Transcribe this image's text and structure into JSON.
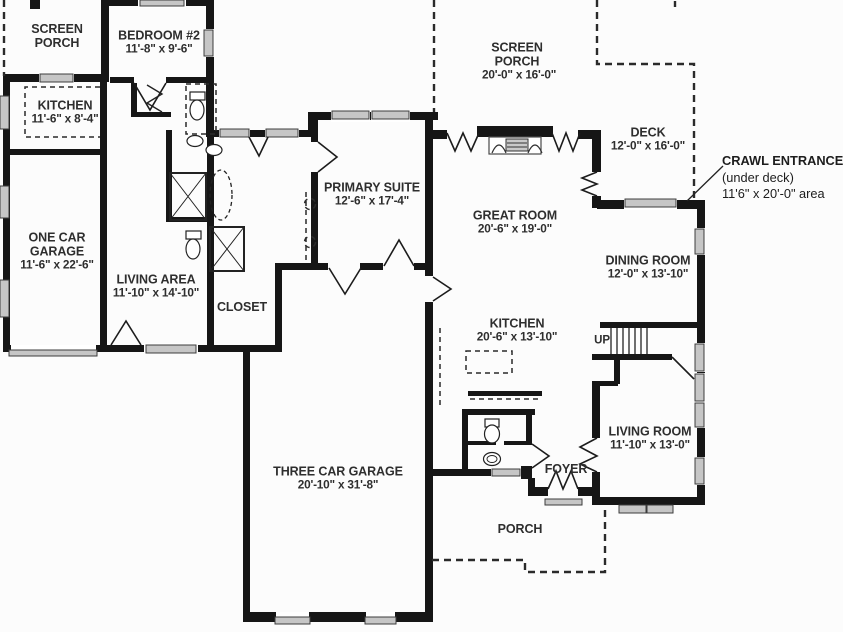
{
  "figure": {
    "type": "floor-plan",
    "wall_color": "#161616",
    "window_color": "#c6c6c6",
    "text_color": "#2e2e2e",
    "background": "#fcfcfc"
  },
  "rooms": [
    {
      "id": "screen-porch-left",
      "name": "SCREEN PORCH",
      "dims": ""
    },
    {
      "id": "bedroom-2",
      "name": "BEDROOM #2",
      "dims": "11'-8\" x 9'-6\""
    },
    {
      "id": "kitchen-left",
      "name": "KITCHEN",
      "dims": "11'-6\" x 8'-4\""
    },
    {
      "id": "one-car-garage",
      "name": "ONE CAR GARAGE",
      "dims": "11'-6\" x 22'-6\""
    },
    {
      "id": "living-area",
      "name": "LIVING AREA",
      "dims": "11'-10\" x 14'-10\""
    },
    {
      "id": "closet",
      "name": "CLOSET",
      "dims": ""
    },
    {
      "id": "primary-suite",
      "name": "PRIMARY SUITE",
      "dims": "12'-6\" x 17'-4\""
    },
    {
      "id": "screen-porch-main",
      "name": "SCREEN PORCH",
      "dims": "20'-0\" x 16'-0\""
    },
    {
      "id": "deck",
      "name": "DECK",
      "dims": "12'-0\" x 16'-0\""
    },
    {
      "id": "great-room",
      "name": "GREAT ROOM",
      "dims": "20'-6\" x 19'-0\""
    },
    {
      "id": "dining-room",
      "name": "DINING ROOM",
      "dims": "12'-0\" x 13'-10\""
    },
    {
      "id": "kitchen-main",
      "name": "KITCHEN",
      "dims": "20'-6\" x 13'-10\""
    },
    {
      "id": "living-room",
      "name": "LIVING ROOM",
      "dims": "11'-10\" x 13'-0\""
    },
    {
      "id": "foyer",
      "name": "FOYER",
      "dims": ""
    },
    {
      "id": "three-car-garage",
      "name": "THREE CAR GARAGE",
      "dims": "20'-10\" x 31'-8\""
    },
    {
      "id": "porch",
      "name": "PORCH",
      "dims": ""
    }
  ],
  "stairs": {
    "label": "UP"
  },
  "annotation": {
    "line1": "CRAWL ENTRANCE",
    "line2": "(under deck)",
    "line3": "11'6\" x 20'-0\" area"
  }
}
